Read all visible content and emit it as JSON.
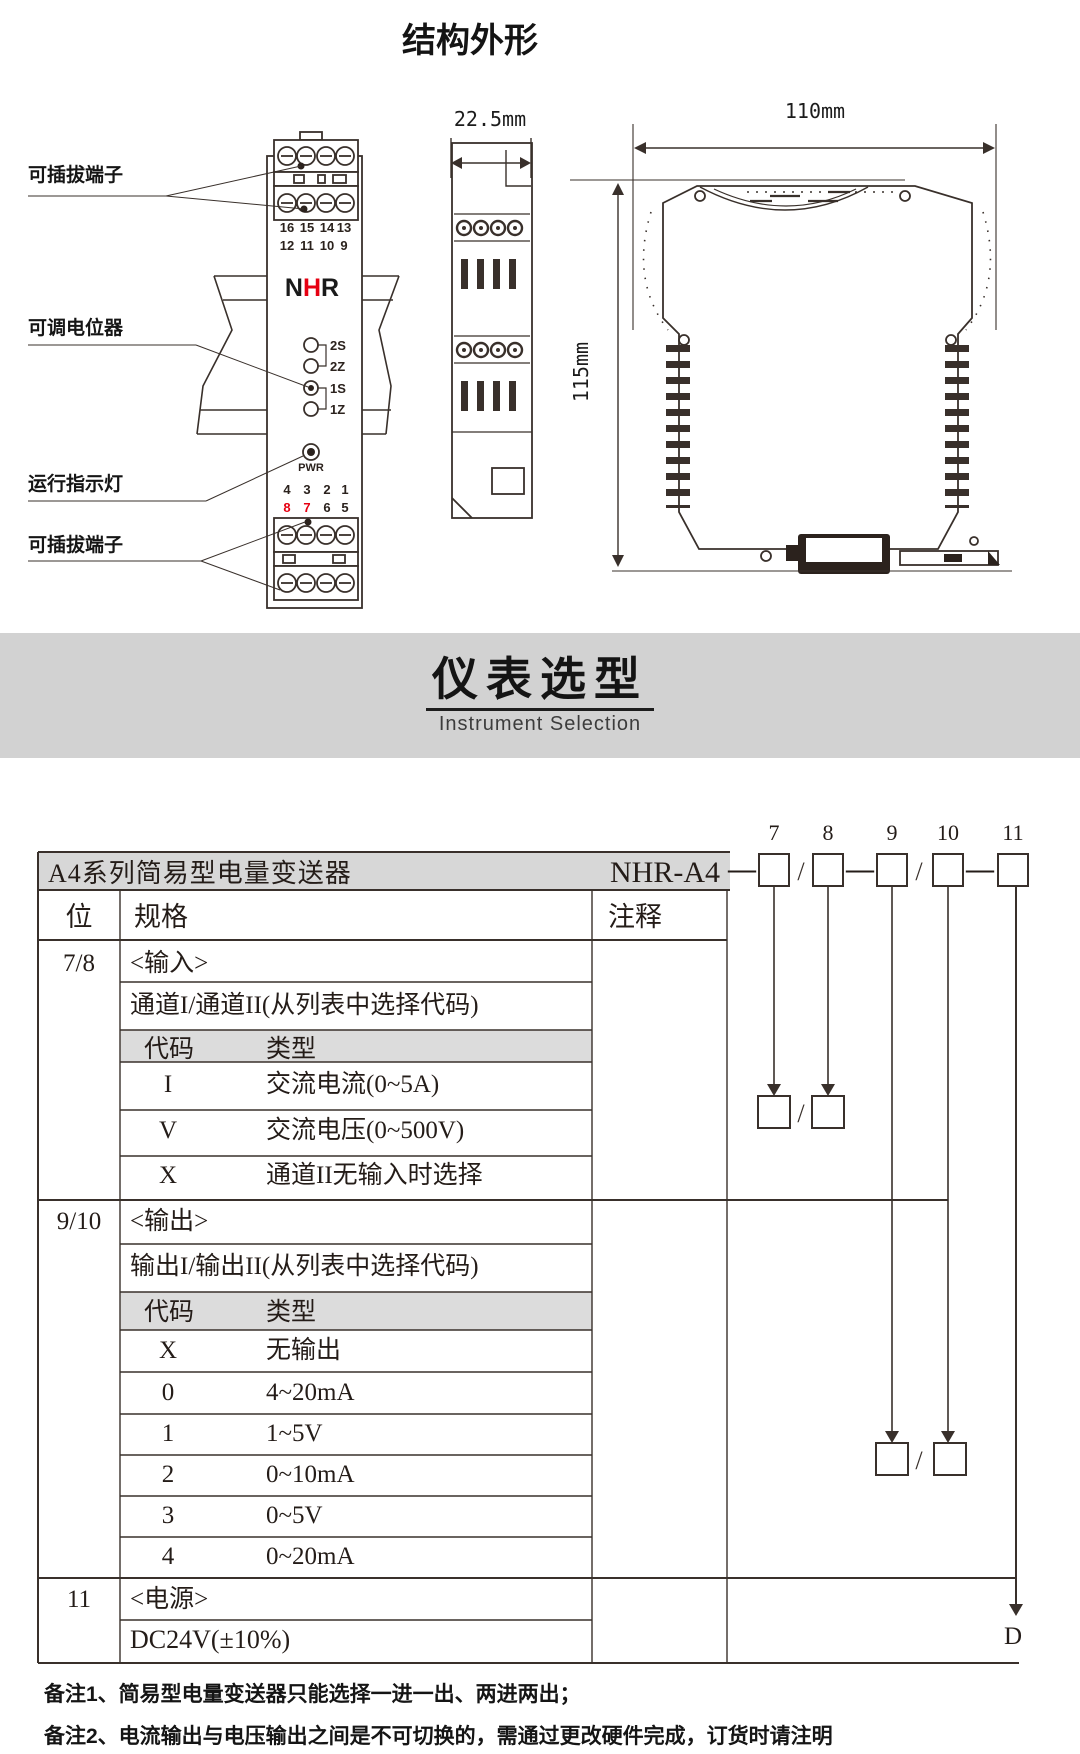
{
  "page": {
    "title": "结构外形"
  },
  "banner": {
    "title": "仪表选型",
    "subtitle": "Instrument Selection"
  },
  "diagram": {
    "callouts": [
      "可插拔端子",
      "可调电位器",
      "运行指示灯",
      "可插拔端子"
    ],
    "front_view": {
      "brand": {
        "n": "N",
        "h": "H",
        "r": "R"
      },
      "top_terminal_numbers_row1": [
        "16",
        "15",
        "14",
        "13"
      ],
      "top_terminal_numbers_row2": [
        "12",
        "11",
        "10",
        "9"
      ],
      "potentiometer_labels": [
        "2S",
        "2Z",
        "1S",
        "1Z"
      ],
      "power_led_label": "PWR",
      "bottom_terminal_numbers_row1": [
        "4",
        "3",
        "2",
        "1"
      ],
      "bottom_terminal_numbers_row2": [
        "8",
        "7",
        "6",
        "5"
      ]
    },
    "dimensions": {
      "depth": "22.5mm",
      "width": "110mm",
      "height": "115mm"
    }
  },
  "selection_table": {
    "product_name": "A4系列简易型电量变送器",
    "model": "NHR-A4",
    "code_positions": [
      "7",
      "8",
      "9",
      "10",
      "11"
    ],
    "headers": {
      "pos": "位",
      "spec": "规格",
      "note": "注释"
    },
    "separators": {
      "slash": "/",
      "dash": "—"
    },
    "sections": [
      {
        "pos": "7/8",
        "group": "<输入>",
        "desc": "通道I/通道II(从列表中选择代码)",
        "sub_headers": {
          "code": "代码",
          "type": "类型"
        },
        "rows": [
          {
            "code": "I",
            "type": "交流电流(0~5A)"
          },
          {
            "code": "V",
            "type": "交流电压(0~500V)"
          },
          {
            "code": "X",
            "type": "通道II无输入时选择"
          }
        ]
      },
      {
        "pos": "9/10",
        "group": "<输出>",
        "desc": "输出I/输出II(从列表中选择代码)",
        "sub_headers": {
          "code": "代码",
          "type": "类型"
        },
        "rows": [
          {
            "code": "X",
            "type": "无输出"
          },
          {
            "code": "0",
            "type": "4~20mA"
          },
          {
            "code": "1",
            "type": "1~5V"
          },
          {
            "code": "2",
            "type": "0~10mA"
          },
          {
            "code": "3",
            "type": "0~5V"
          },
          {
            "code": "4",
            "type": "0~20mA"
          }
        ]
      },
      {
        "pos": "11",
        "group": "<电源>",
        "desc": "DC24V(±10%)",
        "code_letter": "D"
      }
    ]
  },
  "notes": [
    "备注1、简易型电量变送器只能选择一进一出、两进两出；",
    "备注2、电流输出与电压输出之间是不可切换的，需通过更改硬件完成，订货时请注明"
  ],
  "colors": {
    "ink": "#2b221d",
    "accent_red": "#e60012",
    "banner_gray": "#d2d2d2",
    "row_gray": "#dcdcdc"
  }
}
